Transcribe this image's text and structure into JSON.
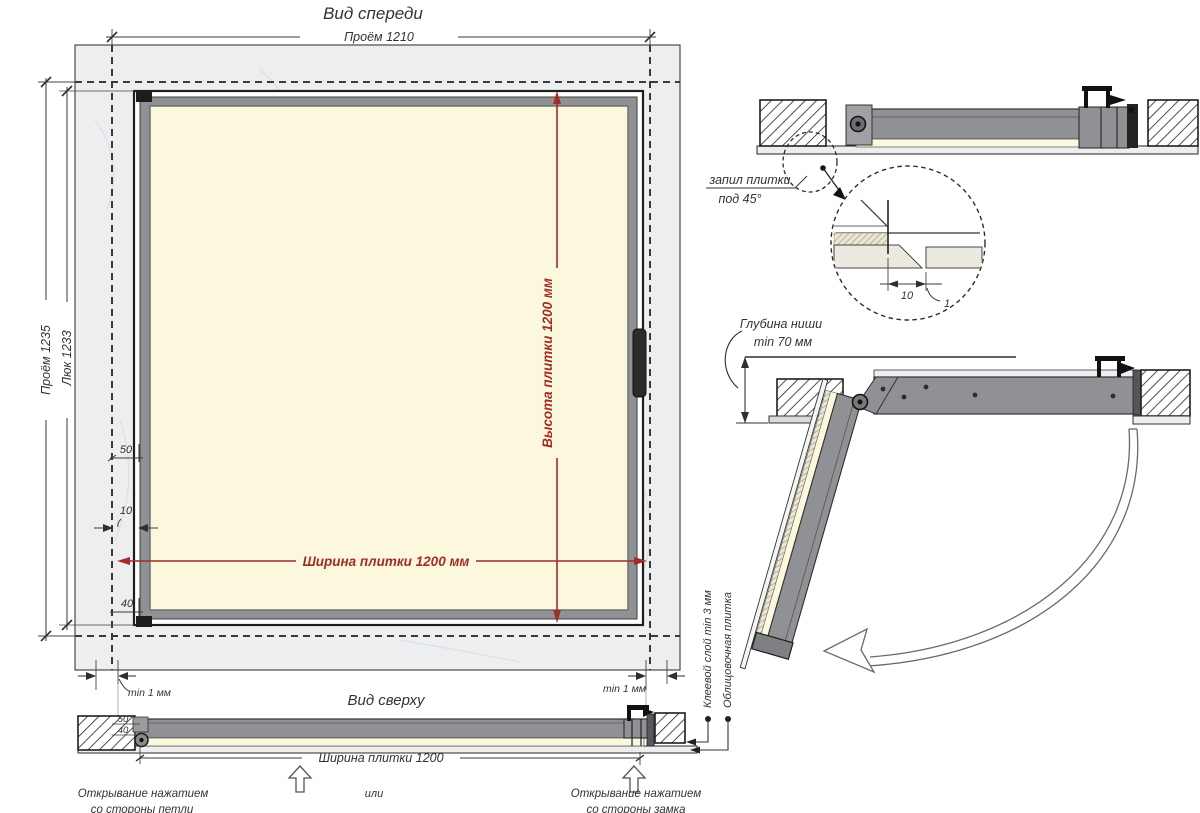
{
  "colors": {
    "accent_red": "#a12c28",
    "frame_gray": "#8f9195",
    "tile_cream": "#fbf8dd",
    "wall_gray": "#eceef0",
    "line_dark": "#2f2f2f"
  },
  "front": {
    "title": "Вид спереди",
    "dim_opening_w": "Проём 1210",
    "dim_opening_h": "Проём 1235",
    "dim_hatch_h": "Люк 1233",
    "dim_tile_h": "Высота плитки 1200 мм",
    "dim_tile_w": "Ширина плитки 1200 мм",
    "dim_50": "50",
    "dim_10": "10",
    "dim_40": "40",
    "dim_gap_left": "min 1 мм",
    "dim_gap_right": "min 1 мм"
  },
  "top": {
    "title": "Вид сверху",
    "dim_50": "50",
    "dim_40": "40",
    "dim_tile_w": "Ширина плитки 1200",
    "caption_left_1": "Открывание нажатием",
    "caption_left_2": "со стороны петли",
    "caption_or": "или",
    "caption_right_1": "Открывание нажатием",
    "caption_right_2": "со стороны замка",
    "label_glue": "Клеевой слой min 3 мм",
    "label_tile": "Облицовочная плитка"
  },
  "closed_section": {
    "label_cut_1": "запил плитки",
    "label_cut_2": "под 45°",
    "dim_10": "10",
    "dim_1": "1"
  },
  "open_section": {
    "label_depth_1": "Глубина ниши",
    "label_depth_2": "min 70 мм"
  }
}
